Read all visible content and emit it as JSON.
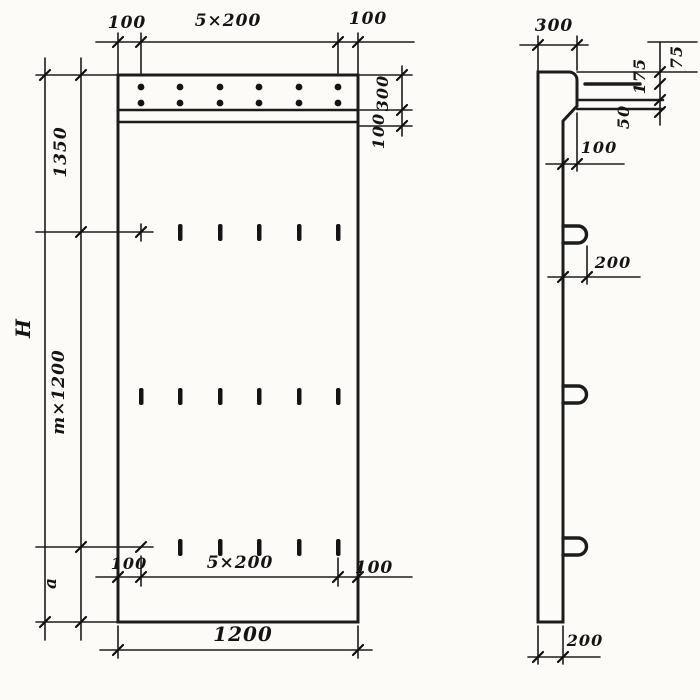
{
  "drawing": {
    "front_view": {
      "top_dims": {
        "left": "100",
        "center": "5×200",
        "right": "100"
      },
      "right_dims": {
        "band_height": "300",
        "below_band": "100"
      },
      "left_dims": {
        "overall_height": "H",
        "top_segment": "1350",
        "middle_segment": "m×1200",
        "bottom_segment": "a"
      },
      "inner_bottom_dims": {
        "left": "100",
        "center": "5×200",
        "right": "100"
      },
      "bottom_width": "1200"
    },
    "side_view": {
      "cap_width": "300",
      "edge_chain": {
        "top": "75",
        "middle": "175",
        "bottom": "50"
      },
      "ledge_offset": "100",
      "loop_projection": "200",
      "panel_thickness": "200"
    }
  }
}
